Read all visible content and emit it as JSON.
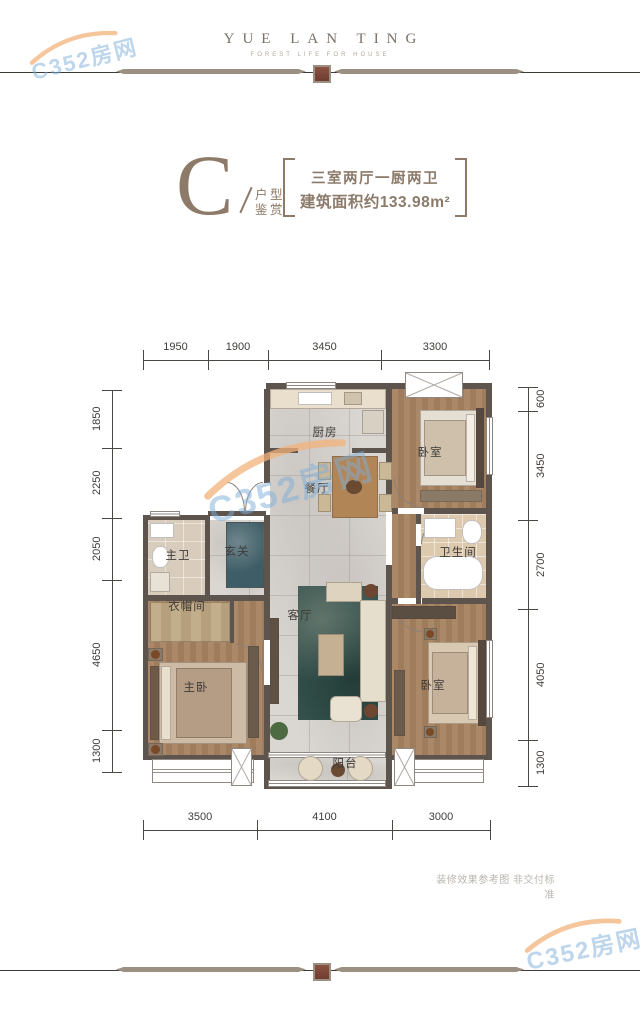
{
  "header": {
    "title": "YUE LAN TING",
    "tagline": "FOREST LIFE FOR HOUSE"
  },
  "unit": {
    "letter": "C",
    "subtitle_line1": "户型",
    "subtitle_line2": "鉴赏",
    "spec": "三室两厅一厨两卫",
    "area": "建筑面积约133.98m²"
  },
  "floorplan": {
    "dims": {
      "top": [
        "1950",
        "1900",
        "3450",
        "3300"
      ],
      "bottom": [
        "3500",
        "4100",
        "3000"
      ],
      "left": [
        "1850",
        "2250",
        "2050",
        "4650",
        "1300"
      ],
      "right": [
        "600",
        "3450",
        "2700",
        "4050",
        "1300"
      ]
    },
    "rooms": [
      {
        "id": "kitchen",
        "label": "厨房"
      },
      {
        "id": "dining",
        "label": "餐厅"
      },
      {
        "id": "bedroom-top",
        "label": "卧室"
      },
      {
        "id": "bathroom",
        "label": "卫生间"
      },
      {
        "id": "master-bath",
        "label": "主卫"
      },
      {
        "id": "foyer",
        "label": "玄关"
      },
      {
        "id": "cloakroom",
        "label": "衣帽间"
      },
      {
        "id": "living",
        "label": "客厅"
      },
      {
        "id": "master-bedroom",
        "label": "主卧"
      },
      {
        "id": "bedroom-bottom",
        "label": "卧室"
      },
      {
        "id": "balcony",
        "label": "阳台"
      }
    ]
  },
  "watermark": {
    "text": "C352房网"
  },
  "footnote": "装修效果参考图 非交付标准",
  "colors": {
    "brand_brown": "#8d7a68",
    "wall": "#5d544e",
    "ornament_red": "#7c4739",
    "watermark_blue": "#7eaed8",
    "watermark_orange": "#f2b27a"
  }
}
